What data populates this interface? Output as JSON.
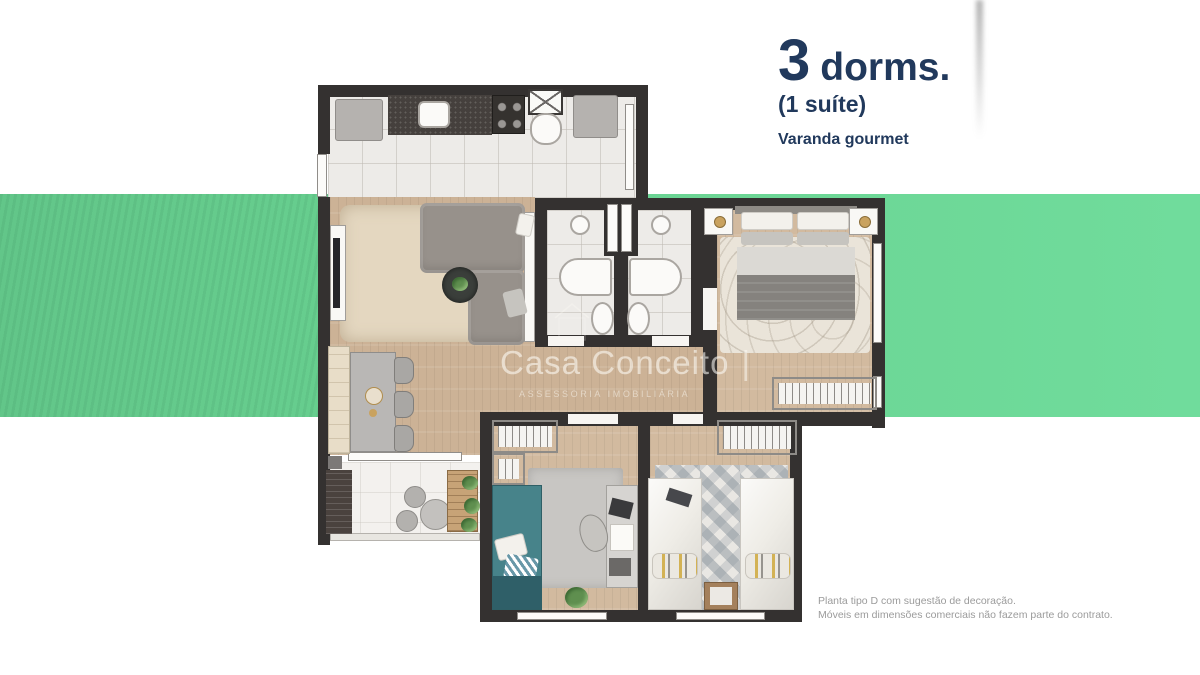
{
  "header": {
    "count": "3",
    "unit": "dorms.",
    "suite_note": "(1 suíte)",
    "feature": "Varanda gourmet"
  },
  "watermark": {
    "brand": "Casa Conceito",
    "separator": "|",
    "subtitle": "ASSESSORIA IMOBILIÁRIA"
  },
  "disclaimer": {
    "line1": "Planta tipo D com sugestão de decoração.",
    "line2": "Móveis em dimensões comerciais não fazem parte do contrato."
  },
  "colors": {
    "band_green_left": "#63c98b",
    "band_green_right": "#6fdc9b",
    "title_navy": "#21395c",
    "wall_charcoal": "#343130",
    "wood_floor": "#ccb296",
    "tile_floor": "#edebe8",
    "teal_bed": "#47838a",
    "disclaimer_gray": "#9b9b9b"
  }
}
